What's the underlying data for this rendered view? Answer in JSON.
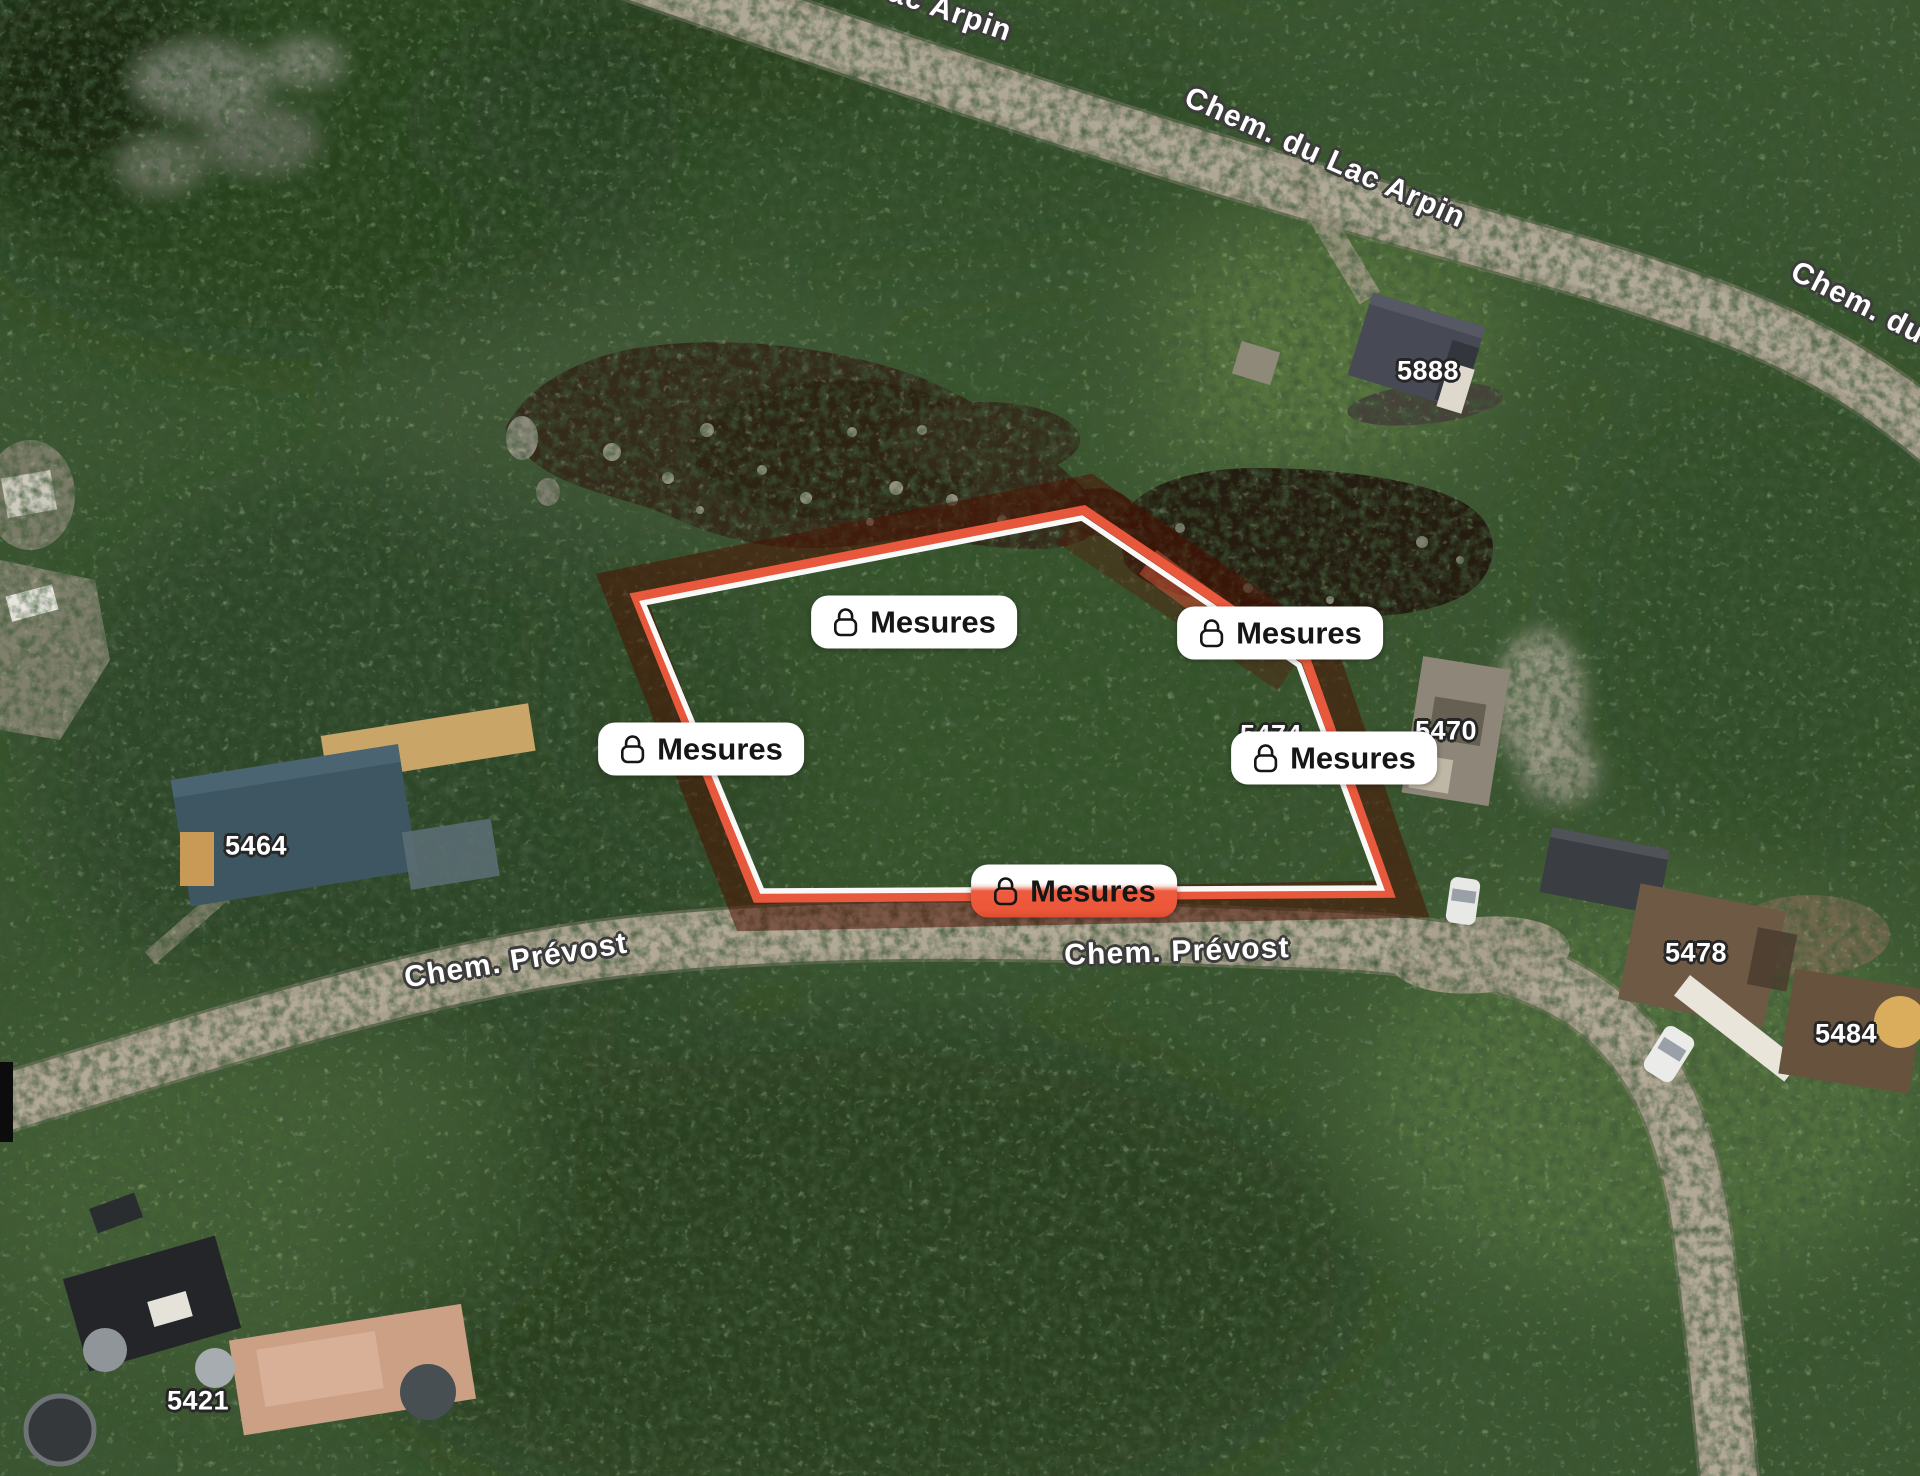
{
  "view": {
    "description": "Satellite map with locked property-boundary measurement overlay",
    "colors": {
      "boundary_accent": "#ee5b3e",
      "boundary_outline": "#ffffff",
      "boundary_shadow": "#4d1002",
      "pill_background": "#ffffff",
      "pill_text": "#161616"
    }
  },
  "pills": [
    {
      "label": "Mesures",
      "icon": "lock-icon",
      "position": "top-center"
    },
    {
      "label": "Mesures",
      "icon": "lock-icon",
      "position": "upper-right"
    },
    {
      "label": "Mesures",
      "icon": "lock-icon",
      "position": "left"
    },
    {
      "label": "Mesures",
      "icon": "lock-icon",
      "position": "right"
    },
    {
      "label": "Mesures",
      "icon": "lock-icon",
      "position": "bottom-center"
    }
  ],
  "road_labels": [
    {
      "text": "ac Arpin"
    },
    {
      "text": "Chem. du Lac Arpin"
    },
    {
      "text": "Chem. du"
    },
    {
      "text": "Chem. Prévost"
    },
    {
      "text": "Chem. Prévost"
    }
  ],
  "house_numbers": [
    {
      "text": "5888"
    },
    {
      "text": "5464"
    },
    {
      "text": "5474"
    },
    {
      "text": "5470"
    },
    {
      "text": "5478"
    },
    {
      "text": "5484"
    },
    {
      "text": "5421"
    }
  ]
}
